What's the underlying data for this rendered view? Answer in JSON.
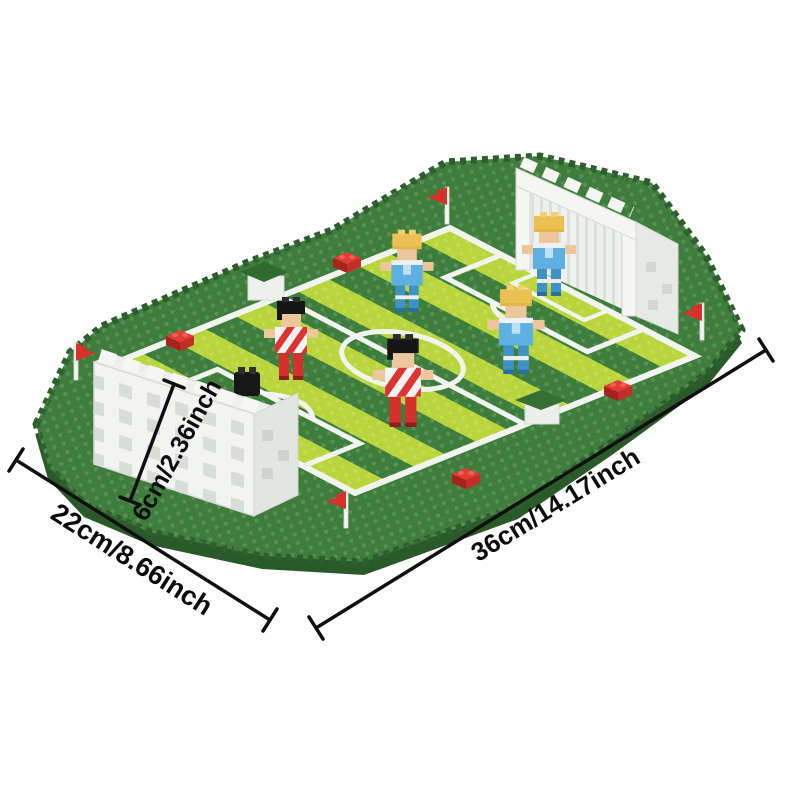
{
  "scene": {
    "type": "product-photo",
    "subject": "micro-brick football pitch building-block model",
    "background_color": "#ffffff"
  },
  "annotations": {
    "length_label": "36cm/14.17inch",
    "width_label": "22cm/8.66inch",
    "height_label": "6cm/2.36inch",
    "line_color": "#101010"
  },
  "model": {
    "red_team_players": 2,
    "blue_team_players": 3,
    "goals": 2,
    "corner_flags": 4,
    "scattered_red_bricks": 4,
    "colors": {
      "base_green": "#3e7d3b",
      "base_edge": "#2d5f2d",
      "stripe_light": "#b9d53c",
      "stripe_dark": "#3e7e3c",
      "pitch_line_white": "#f1f3ee",
      "goal_white": "#f3f4f2",
      "flag_red": "#d8312c",
      "brick_red": "#e23c33",
      "shirt_red": "#dc3531",
      "shirt_blue": "#5db0e0",
      "skin": "#ecc79b",
      "hair_black": "#161616",
      "hair_blond": "#ecc152"
    }
  }
}
